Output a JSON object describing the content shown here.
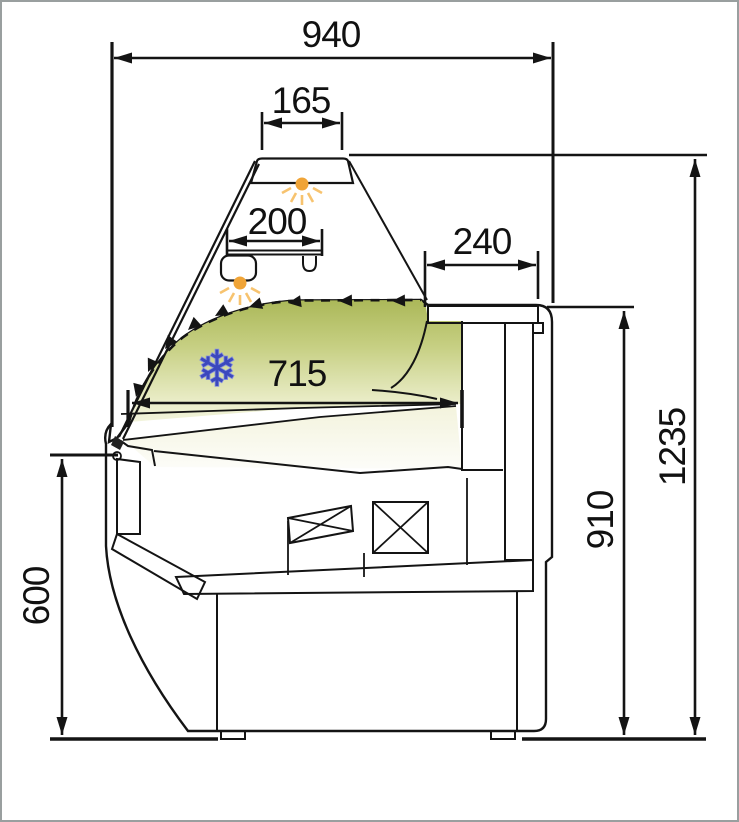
{
  "drawing": {
    "type": "technical-drawing",
    "subject": "refrigerated-display-counter-cross-section",
    "dims": {
      "overall_width": "940",
      "canopy_width": "165",
      "shelf_width": "200",
      "top_rear_depth": "240",
      "display_depth": "715",
      "overall_height": "1235",
      "rear_height": "910",
      "front_height": "600"
    },
    "icons": {
      "snowflake": "❄"
    },
    "colors": {
      "display_green": "#b4bf61",
      "lamp_orange": "#f0a437",
      "lamp_ray_orange": "#f7c36f",
      "snowflake_blue": "#3b48bd",
      "body_gray": "#e1e6e5",
      "hatch_gray": "#c6d0cf",
      "line_black": "#141414"
    }
  }
}
